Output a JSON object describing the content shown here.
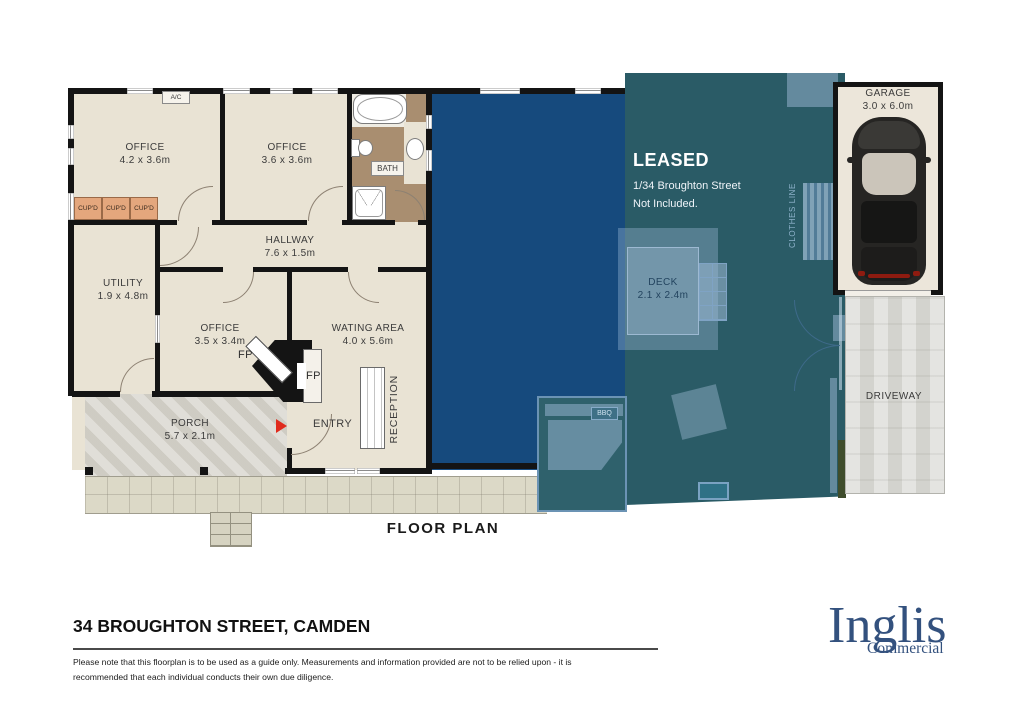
{
  "floorplan": {
    "title": "FLOOR PLAN",
    "rooms": {
      "office1": {
        "name": "OFFICE",
        "dims": "4.2 x 3.6m"
      },
      "office2": {
        "name": "OFFICE",
        "dims": "3.6 x 3.6m"
      },
      "office3": {
        "name": "OFFICE",
        "dims": "3.5 x 3.4m"
      },
      "hallway": {
        "name": "HALLWAY",
        "dims": "7.6 x 1.5m"
      },
      "utility": {
        "name": "UTILITY",
        "dims": "1.9 x 4.8m"
      },
      "waiting_area": {
        "name": "WATING AREA",
        "dims": "4.0 x 5.6m"
      },
      "porch": {
        "name": "PORCH",
        "dims": "5.7 x 2.1m"
      },
      "deck": {
        "name": "DECK",
        "dims": "2.1 x 2.4m"
      },
      "garage": {
        "name": "GARAGE",
        "dims": "3.0 x 6.0m"
      },
      "bath": {
        "name": "BATH"
      },
      "driveway": {
        "name": "DRIVEWAY"
      }
    },
    "labels": {
      "ac": "A/C",
      "cupd": "CUP'D",
      "fp": "FP",
      "entry": "ENTRY",
      "reception": "RECEPTION",
      "bbq": "BBQ",
      "clothes_line": "CLOTHES LINE"
    },
    "leased": {
      "title": "LEASED",
      "line1": "1/34 Broughton Street",
      "line2": "Not Included."
    }
  },
  "footer": {
    "address": "34 BROUGHTON STREET, CAMDEN",
    "disclaimer_line1": "Please note that this floorplan is to be used as a guide only. Measurements and information provided are not to be relied upon - it is",
    "disclaimer_line2": "recommended that each individual conducts their own due diligence.",
    "logo": {
      "name": "Inglis",
      "sub": "Commercial"
    }
  },
  "colors": {
    "leased_blue": "#164a7d",
    "yard_teal": "#2a5b66",
    "logo_blue": "#33517e",
    "wall_black": "#141414",
    "floor_cream": "#e9e3d4",
    "entry_arrow_red": "#e02b1d"
  }
}
